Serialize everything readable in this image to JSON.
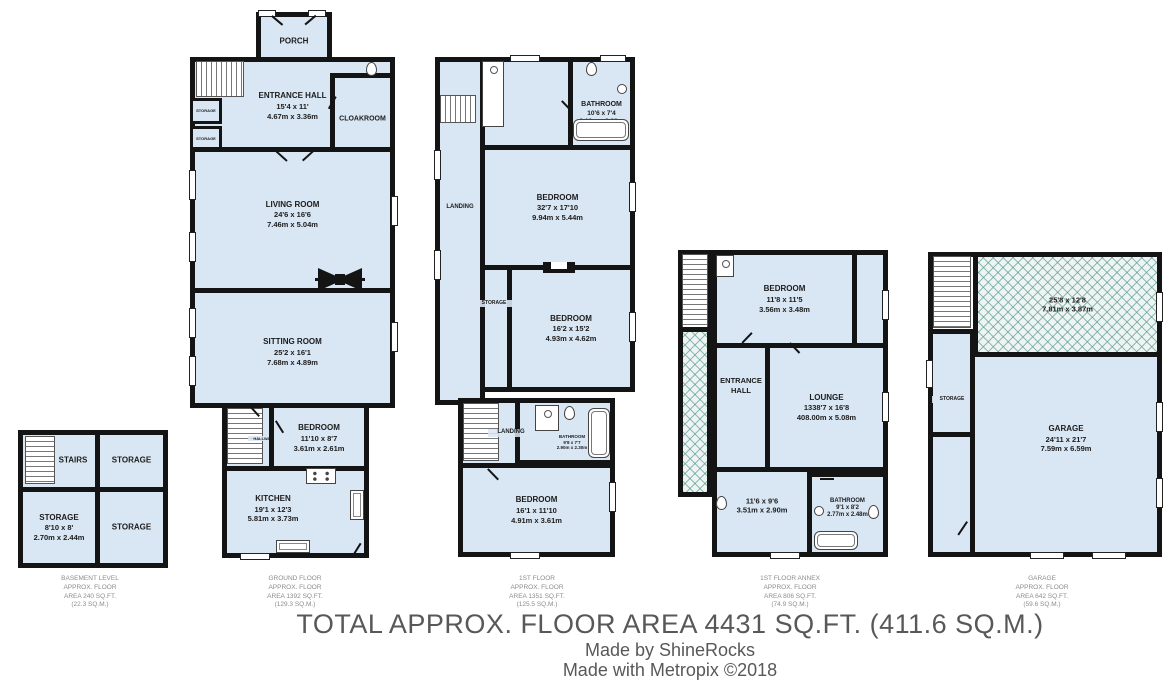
{
  "colors": {
    "room_fill": "#d9e6f3",
    "wall": "#141414",
    "hatch_line": "#5a9a92",
    "caption_text": "#8c8c8c",
    "footer_text": "#58585a"
  },
  "rooms": {
    "bsmt_stairs": {
      "name": "STAIRS"
    },
    "bsmt_storage_tr": {
      "name": "STORAGE"
    },
    "bsmt_storage_bl": {
      "name": "STORAGE",
      "ft": "8'10 x 8'",
      "m": "2.70m x 2.44m"
    },
    "bsmt_storage_br": {
      "name": "STORAGE"
    },
    "gf_porch": {
      "name": "PORCH"
    },
    "gf_entrance": {
      "name": "ENTRANCE HALL",
      "ft": "15'4 x 11'",
      "m": "4.67m x 3.36m"
    },
    "gf_cloakroom": {
      "name": "CLOAKROOM"
    },
    "gf_storage1": {
      "name": "STORAGE"
    },
    "gf_storage2": {
      "name": "STORAGE"
    },
    "gf_living": {
      "name": "LIVING ROOM",
      "ft": "24'6 x 16'6",
      "m": "7.46m x 5.04m"
    },
    "gf_sitting": {
      "name": "SITTING ROOM",
      "ft": "25'2 x 16'1",
      "m": "7.68m x 4.89m"
    },
    "gf_hallway": {
      "name": "HALLWAY"
    },
    "gf_bedroom": {
      "name": "BEDROOM",
      "ft": "11'10 x 8'7",
      "m": "3.61m x 2.61m"
    },
    "gf_kitchen": {
      "name": "KITCHEN",
      "ft": "19'1 x 12'3",
      "m": "5.81m x 3.73m"
    },
    "ff_landing": {
      "name": "LANDING"
    },
    "ff_bath_top": {
      "name": "BATHROOM",
      "ft": "10'6 x 7'4",
      "m": "3.19m x 2.23m"
    },
    "ff_bed_big": {
      "name": "BEDROOM",
      "ft": "32'7 x 17'10",
      "m": "9.94m x 5.44m"
    },
    "ff_storage": {
      "name": "STORAGE"
    },
    "ff_bed_mid": {
      "name": "BEDROOM",
      "ft": "16'2 x 15'2",
      "m": "4.93m x 4.62m"
    },
    "ff_landing2": {
      "name": "LANDING"
    },
    "ff_bath_small": {
      "name": "BATHROOM",
      "ft": "9'8 x 7'7",
      "m": "2.90m x 2.30m"
    },
    "ff_bed_bot": {
      "name": "BEDROOM",
      "ft": "16'1 x 11'10",
      "m": "4.91m x 3.61m"
    },
    "ax_bedroom": {
      "name": "BEDROOM",
      "ft": "11'8 x 11'5",
      "m": "3.56m x 3.48m"
    },
    "ax_entrance": {
      "name": "ENTRANCE HALL"
    },
    "ax_lounge": {
      "name": "LOUNGE",
      "ft": "1338'7 x 16'8",
      "m": "408.00m x 5.08m"
    },
    "ax_room": {
      "ft": "11'6 x 9'6",
      "m": "3.51m x 2.90m"
    },
    "ax_bath": {
      "name": "BATHROOM",
      "ft": "9'1 x 8'2",
      "m": "2.77m x 2.48m"
    },
    "gr_loft": {
      "ft": "25'8 x 12'8",
      "m": "7.81m x 3.87m"
    },
    "gr_storage": {
      "name": "STORAGE"
    },
    "gr_garage": {
      "name": "GARAGE",
      "ft": "24'11 x 21'7",
      "m": "7.59m x 6.59m"
    }
  },
  "captions": {
    "basement": {
      "l1": "BASEMENT LEVEL",
      "l2": "APPROX. FLOOR",
      "l3": "AREA 240 SQ.FT.",
      "l4": "(22.3 SQ.M.)"
    },
    "ground": {
      "l1": "GROUND FLOOR",
      "l2": "APPROX. FLOOR",
      "l3": "AREA 1392 SQ.FT.",
      "l4": "(129.3 SQ.M.)"
    },
    "first": {
      "l1": "1ST FLOOR",
      "l2": "APPROX. FLOOR",
      "l3": "AREA 1351 SQ.FT.",
      "l4": "(125.5 SQ.M.)"
    },
    "annex": {
      "l1": "1ST FLOOR ANNEX",
      "l2": "APPROX. FLOOR",
      "l3": "AREA 806 SQ.FT.",
      "l4": "(74.9 SQ.M.)"
    },
    "garage": {
      "l1": "GARAGE",
      "l2": "APPROX. FLOOR",
      "l3": "AREA 642 SQ.FT.",
      "l4": "(59.6 SQ.M.)"
    }
  },
  "footer": {
    "total": "TOTAL APPROX. FLOOR AREA 4431 SQ.FT. (411.6 SQ.M.)",
    "made_by": "Made by ShineRocks",
    "made_with": "Made with Metropix ©2018"
  }
}
